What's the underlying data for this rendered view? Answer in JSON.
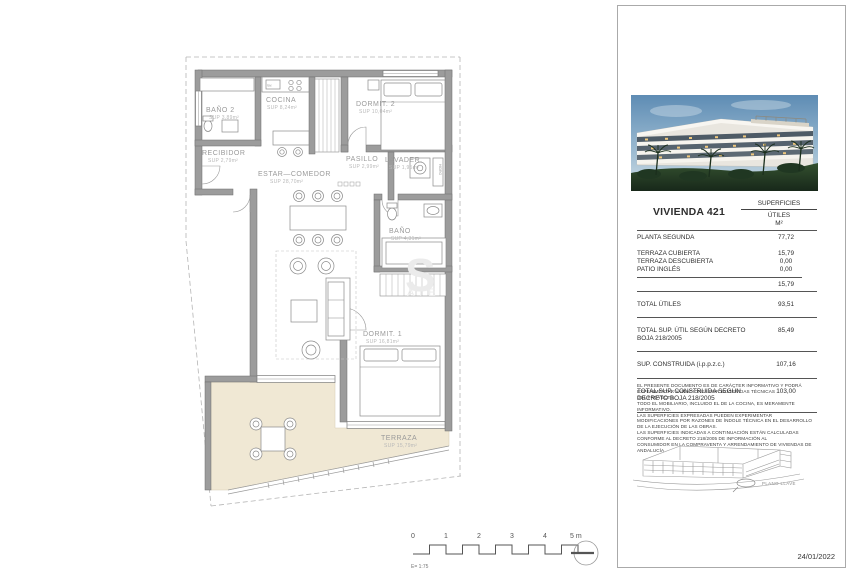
{
  "plan": {
    "rooms": [
      {
        "name": "BAÑO 2",
        "sup": "SUP  3,89m²"
      },
      {
        "name": "COCINA",
        "sup": "SUP  8,24m²"
      },
      {
        "name": "DORMIT. 2",
        "sup": "SUP  10,04m²"
      },
      {
        "name": "RECIBIDOR",
        "sup": "SUP  2,79m²"
      },
      {
        "name": "ESTAR—COMEDOR",
        "sup": "SUP  28,70m²"
      },
      {
        "name": "PASILLO",
        "sup": "SUP  2,99m²"
      },
      {
        "name": "LAVADER.",
        "sup": "SUP  1,95m²"
      },
      {
        "name": "BAÑO",
        "sup": "SUP  4,31m²"
      },
      {
        "name": "DORMIT. 1",
        "sup": "SUP  16,81m²"
      },
      {
        "name": "TERRAZA",
        "sup": "SUP  15,79m²"
      }
    ],
    "annotations": {
      "sink": "lav.",
      "hidro": "HIDRO"
    },
    "watermark": {
      "letter": "S",
      "word": "ATE"
    }
  },
  "scalebar": {
    "ticks": [
      "0",
      "1",
      "2",
      "3",
      "4",
      "5 m"
    ],
    "scale_note": "E= 1:75"
  },
  "panel": {
    "unit_title": "VIVIENDA 421",
    "column_header": {
      "line1": "SUPERFICIES",
      "line2": "ÚTILES",
      "line3": "M²"
    },
    "table": {
      "rows": [
        {
          "label": "PLANTA SEGUNDA",
          "value": "77,72"
        },
        {
          "label": "TERRAZA CUBIERTA",
          "value": "15,79"
        },
        {
          "label": "TERRAZA DESCUBIERTA",
          "value": "0,00"
        },
        {
          "label": "PATIO INGLÉS",
          "value": "0,00"
        },
        {
          "label": "",
          "value": "15,79"
        },
        {
          "label": "TOTAL ÚTILES",
          "value": "93,51"
        },
        {
          "label": "TOTAL SUP. ÚTIL SEGÚN DECRETO BOJA 218/2005",
          "value": "85,49"
        },
        {
          "label": "SUP. CONSTRUIDA (i.p.p.z.c.)",
          "value": "107,16"
        },
        {
          "label": "TOTAL SUP. CONSTRUIDA SEGÚN DECRETO BOJA 218/2005",
          "value": "103,00"
        }
      ]
    },
    "disclaimer": [
      "EL PRESENTE DOCUMENTO ES DE CARÁCTER INFORMATIVO Y PODRÁ EXPERIMENTAR VARIACIONES POR EXIGENCIAS TÉCNICAS",
      "DEL PROYECTO.",
      "TODO EL MOBILIARIO, INCLUIDO EL DE LA COCINA, ES MERAMENTE INFORMATIVO.",
      "LAS SUPERFICIES EXPRESADAS PUEDEN EXPERIMENTAR MODIFICACIONES POR RAZONES DE ÍNDOLE TÉCNICA EN EL DESARROLLO",
      "DE LA EJECUCIÓN DE LAS OBRAS.",
      "LAS SUPERFICIES INDICADAS A CONTINUACIÓN ESTÁN CALCULADAS CONFORME AL DECRETO 218/2005 DE INFORMACIÓN AL",
      "CONSUMIDOR EN LA COMPRAVENTA Y ARRENDAMIENTO DE VIVIENDAS DE ANDALUCÍA."
    ],
    "keyplan_label": "PLANO LLAVE",
    "date": "24/01/2022"
  }
}
